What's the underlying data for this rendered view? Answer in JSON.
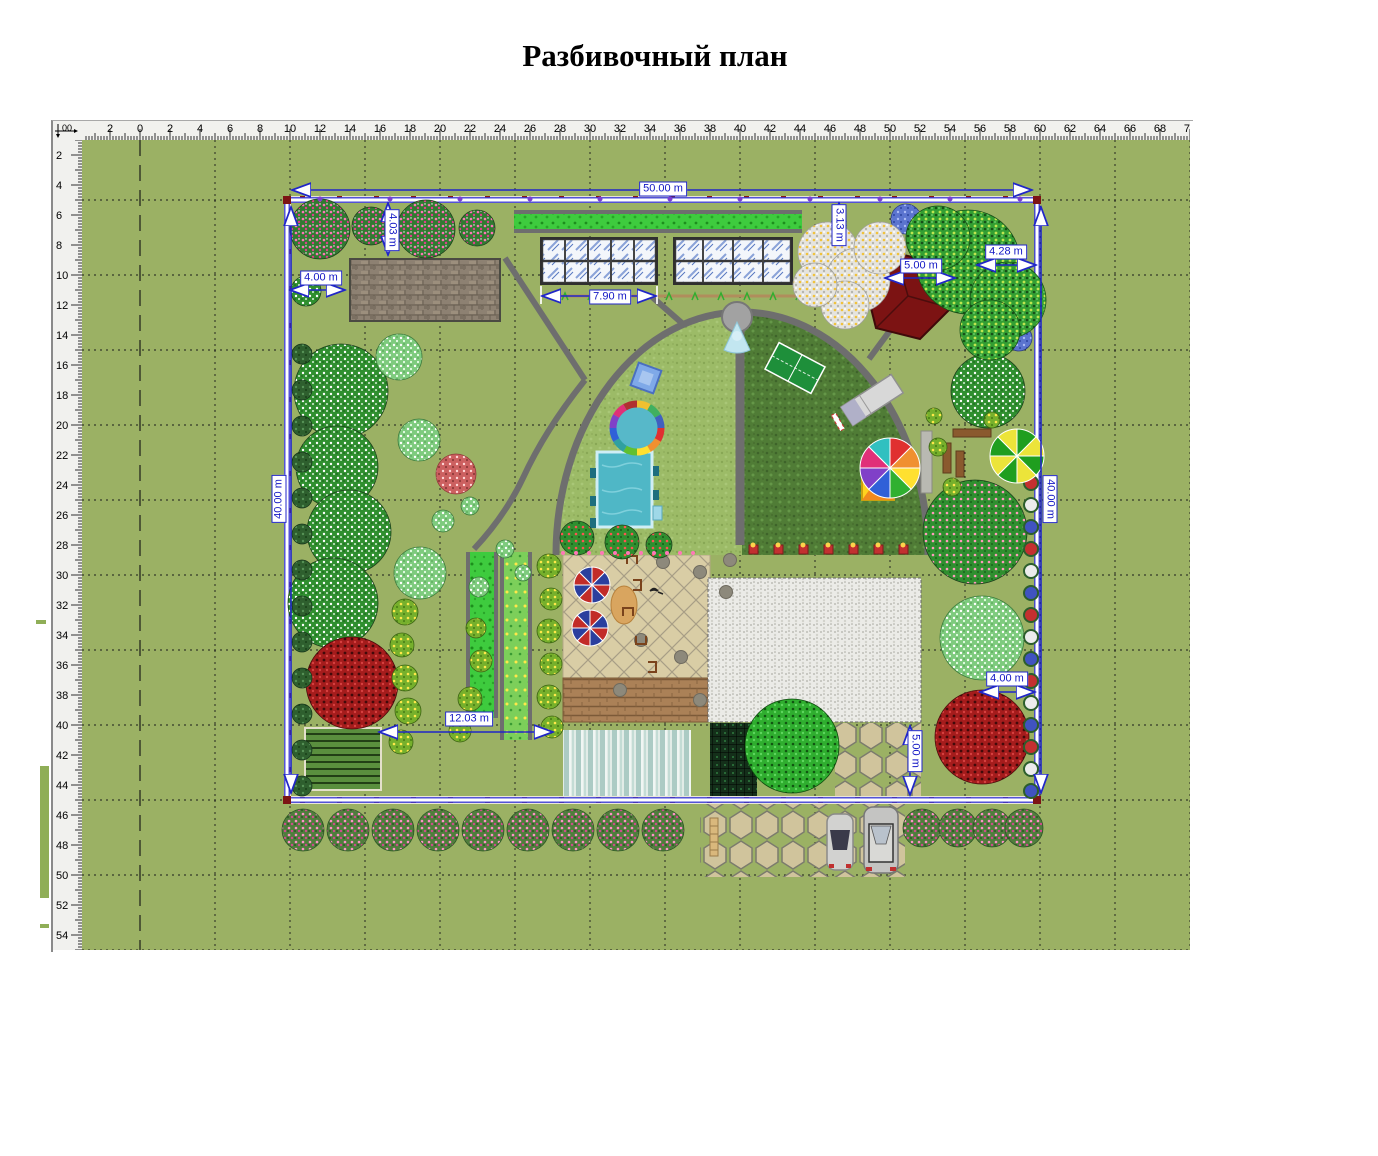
{
  "title": "Разбивочный план",
  "ruler": {
    "origin": "00",
    "h_labels": [
      "2",
      "0",
      "2",
      "4",
      "6",
      "8",
      "10",
      "12",
      "14",
      "16",
      "18",
      "20",
      "22",
      "24",
      "26",
      "28",
      "30",
      "32",
      "34",
      "36",
      "38",
      "40",
      "42",
      "44",
      "46",
      "48",
      "50",
      "52",
      "54",
      "56",
      "58",
      "60",
      "62",
      "64",
      "66",
      "68",
      "70"
    ],
    "v_labels": [
      "2",
      "4",
      "6",
      "8",
      "10",
      "12",
      "14",
      "16",
      "18",
      "20",
      "22",
      "24",
      "26",
      "28",
      "30",
      "32",
      "34",
      "36",
      "38",
      "40",
      "42",
      "44",
      "46",
      "48",
      "50",
      "52",
      "54"
    ]
  },
  "dimensions": [
    {
      "name": "dim-plot-width",
      "label": "50.00 m",
      "x": 663,
      "y": 189,
      "rot": 0
    },
    {
      "name": "dim-plot-height-left",
      "label": "40.00 m",
      "x": 279,
      "y": 499,
      "rot": -90
    },
    {
      "name": "dim-plot-height-right",
      "label": "40.00 m",
      "x": 1050,
      "y": 499,
      "rot": 90
    },
    {
      "name": "dim-shed-offset-vertical",
      "label": "4.03 m",
      "x": 392,
      "y": 230,
      "rot": 90
    },
    {
      "name": "dim-shed-offset-horizontal",
      "label": "4.00 m",
      "x": 321,
      "y": 278,
      "rot": 0
    },
    {
      "name": "dim-greenhouse-width",
      "label": "7.90 m",
      "x": 610,
      "y": 297,
      "rot": 0
    },
    {
      "name": "dim-gazebo-offset",
      "label": "3.13 m",
      "x": 839,
      "y": 225,
      "rot": 90
    },
    {
      "name": "dim-gazebo-width",
      "label": "5.00 m",
      "x": 921,
      "y": 266,
      "rot": 0
    },
    {
      "name": "dim-tree-offset",
      "label": "4.28 m",
      "x": 1006,
      "y": 252,
      "rot": 0
    },
    {
      "name": "dim-garden-width",
      "label": "12.03 m",
      "x": 469,
      "y": 719,
      "rot": 0
    },
    {
      "name": "dim-tree-offset-right",
      "label": "4.00 m",
      "x": 1007,
      "y": 679,
      "rot": 0
    },
    {
      "name": "dim-driveway-depth",
      "label": "5.00 m",
      "x": 915,
      "y": 751,
      "rot": 90
    }
  ],
  "colors": {
    "canvas_green": "#9bb164",
    "dimension_blue": "#2026c8",
    "fence_post_red": "#8c1812",
    "hedge_green": "#3ecb3e",
    "grid": "#1a1a1a"
  }
}
